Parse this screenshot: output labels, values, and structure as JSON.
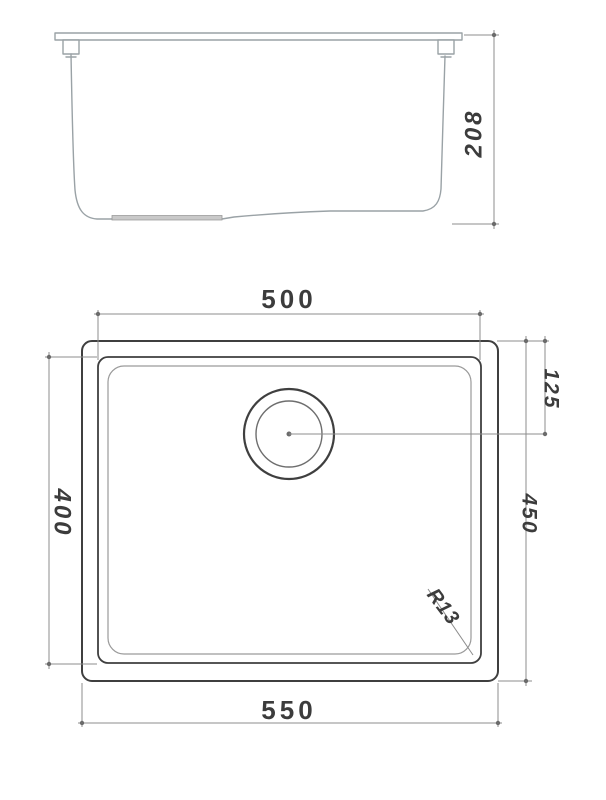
{
  "dimensions": {
    "depth": "208",
    "bowl_width": "500",
    "overall_width": "550",
    "bowl_length": "400",
    "overall_length": "450",
    "drain_offset": "125",
    "corner_radius": "R13"
  },
  "colors": {
    "line-dark": "#3f3f3f",
    "line-light": "#9aa2a6",
    "line-dim": "#8c8c8c",
    "dot": "#6b6b6b",
    "text": "#3c3c3c",
    "pad-fill": "#c9c9c9",
    "background": "#ffffff"
  }
}
